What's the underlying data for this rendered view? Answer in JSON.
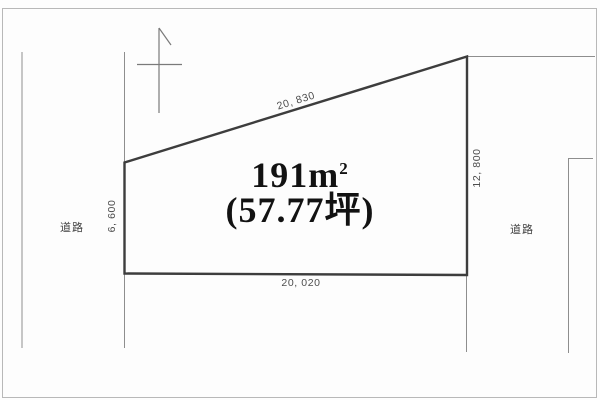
{
  "diagram": {
    "type": "land-plot-survey",
    "area": {
      "value": "191",
      "unit_base": "m",
      "unit_sup": "2",
      "tsubo": "(57.77坪)"
    },
    "dimensions": {
      "top": "20, 830",
      "right": "12, 800",
      "left": "6, 600",
      "bottom": "20, 020"
    },
    "roads": {
      "left": "道路",
      "right": "道路"
    },
    "colors": {
      "plot_outline": "#3d3d3d",
      "boundary_line": "#8e8e8e",
      "page_border": "#b8b8b8",
      "dimension_text": "#4d4d4d",
      "area_text": "#121212",
      "background": "#fdfdfd"
    }
  }
}
